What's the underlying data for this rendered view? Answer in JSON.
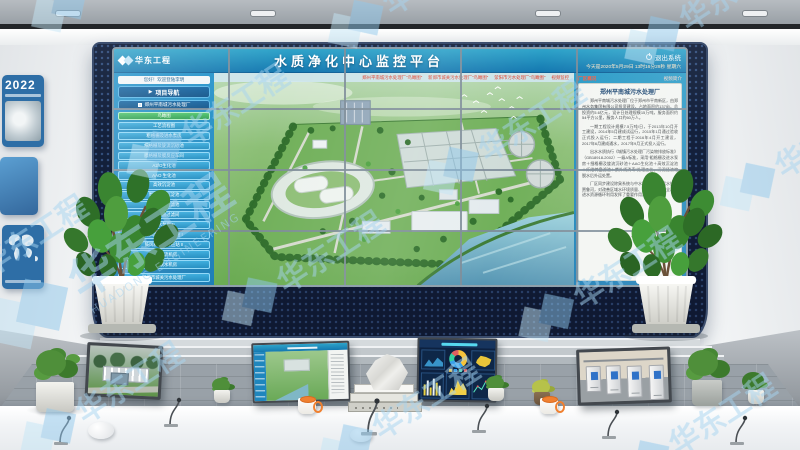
{
  "watermark": {
    "company": "华东工程",
    "company_en": "HUADONG ENGINEERING"
  },
  "left_wall": {
    "year": "2022"
  },
  "screen": {
    "logo_text": "华东工程",
    "title": "水质净化中心监控平台",
    "datetime": "今天是2020年5月29日 13时16分29秒 星期六",
    "exit_label": "退出系统",
    "welcome": "您好！欢迎登陆李明",
    "quick_links": [
      "郑州平南城污水处理厂“鸟瞰图”",
      "新郑市城关污水处理厂“鸟瞰图”",
      "荥阳市污水处理厂“鸟瞰图”",
      "视频监控"
    ],
    "sidebar": {
      "nav_button": "项目导航",
      "plant_button": "郑州平南城污水处理厂",
      "items": [
        "鸟瞰图",
        "工艺流程图",
        "粗格栅及进水泵房",
        "细格栅及旋流沉砂池",
        "膜格栅及膜反应车间",
        "A2/O生化池",
        "AAO 生化池",
        "高效沉淀池",
        "周进周出沉淀池",
        "纤维转盘过滤池",
        "纤维转盘过滤间",
        "进水泵房 II",
        "鼓风机房及反应站 I",
        "鼓风机房及反应站 II",
        "污泥回流机房",
        "污泥脱水机房"
      ],
      "bottom_button": "新郑市城关污水处理厂"
    },
    "info_panel": {
      "tab_left": "厂区概况",
      "tab_right": "视频简介",
      "title": "郑州平南城污水处理厂",
      "paragraphs": [
        "郑州平南城污水处理厂位于郑州市平南新区，由郑州水务集团有限公司投资建设，占地面积约137亩，总投资约5.6亿元，设计日处理规模15万吨，服务面积约54平方公里，服务人口约60万人。",
        "一期工程设计规模7.5万吨/日，于2013年10月开工建设，2014年5月建成试运行，2015年1月通过验收正式投入运行；二期工程于2016年4月开工建设，2017年6月建成通水，2017年9月正式投入运行。",
        "出水水质执行《城镇污水处理厂污染物排放标准》（GB18918-2002）一级A标准，采用“粗格栅及进水泵房＋细格栅及旋流沉砂池＋AAO生化池＋高效沉淀池＋纤维转盘滤池＋紫外线消毒”处理工艺，污泥经浓缩脱水后外运处置。",
        "厂区同步建设除臭系统与中水回用系统，尾水排入贾鲁河，对改善区域水环境质量、保障流域水安全、促进水资源循环利用发挥了重要作用。"
      ]
    }
  }
}
